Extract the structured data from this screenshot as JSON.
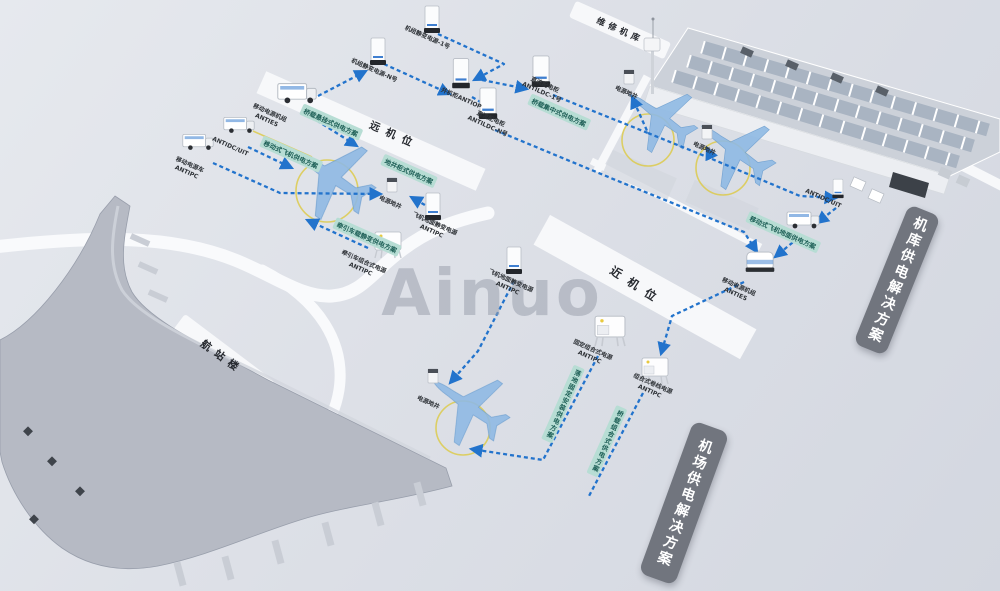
{
  "watermark": "Ainuo",
  "zones": {
    "hangar": "维修机库",
    "remote_stand": "远机位",
    "near_stand": "近机位",
    "terminal": "航站楼"
  },
  "banners": {
    "hangar_power": "机库供电解决方案",
    "airport_power": "机场供电解决方案"
  },
  "solution_tags": {
    "bridge_suspended": "桥载悬挂式供电方案",
    "mobile_aircraft": "移动式飞机供电方案",
    "pit_cabinet": "地井柜式供电方案",
    "tractor_static": "牵引车载静变供电方案",
    "bridge_central": "桥载集中式供电方案",
    "mobile_ground": "移动式飞机地面供电方案",
    "floor_fixed": "落地固定安装供电方案",
    "bridge_combined": "桥载组合式供电方案"
  },
  "equipment": {
    "genset_unit_1": "机组静变电源-1号",
    "genset_unit_n": "机组静变电源-N号",
    "parallel_cabinet": "并机柜ANTIOP",
    "dc_cabinet_1": {
      "name": "直流配电柜",
      "model": "ANTILDC-1号"
    },
    "dc_cabinet_n": {
      "name": "直流配电柜",
      "model": "ANTILDC-N号"
    },
    "power_pit_hangar_1": "电源地井",
    "power_pit_hangar_2": "电源地井",
    "dc_uit_right": "ANTIDC/UIT",
    "mobile_genset_right": {
      "name": "移动电源机组",
      "model": "ANTIES"
    },
    "mobile_genset_left": {
      "name": "移动电源机组",
      "model": "ANTIES"
    },
    "dc_uit_left": "ANTIDC/UIT",
    "mobile_cart": {
      "name": "移动电源车",
      "model": "ANTIPC"
    },
    "power_pit_remote": "电源地井",
    "sfc_remote": {
      "name": "飞机地面静变电源",
      "model": "ANTIPC"
    },
    "tractor_combo": {
      "name": "牵引车组合式电源",
      "model": "ANTIPC"
    },
    "sfc_mid": {
      "name": "飞机地面静变电源",
      "model": "ANTIPC"
    },
    "power_pit_near": "电源地井",
    "fixed_combo": {
      "name": "固定组合式电源",
      "model": "ANTIPC"
    },
    "combo_reel": {
      "name": "组合式卷线电源",
      "model": "ANTIPC"
    }
  },
  "colors": {
    "route_blue": "#2273cc",
    "tag_bg": "#b7ddd4",
    "tag_text": "#1d5f56",
    "banner_bg": "#71757e",
    "plane_blue": "#8fb9e4",
    "guide_yellow": "#ddc93f",
    "background": "#d9dce3",
    "strip_white": "#f7f8fa"
  }
}
